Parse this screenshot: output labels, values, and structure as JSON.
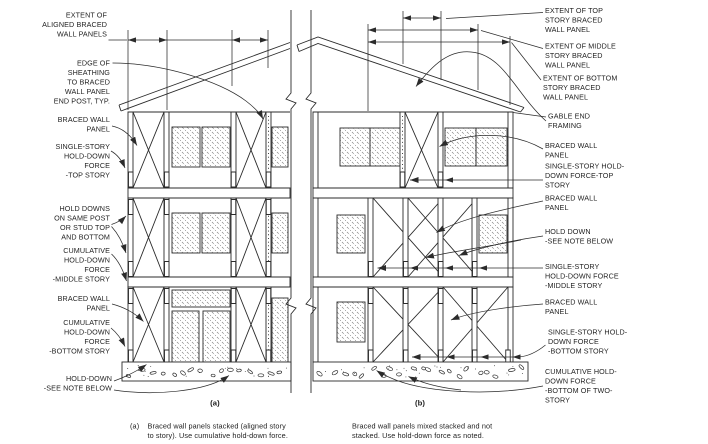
{
  "diagram": {
    "left_labels": [
      {
        "lines": [
          "EXTENT OF",
          "ALIGNED BRACED",
          "WALL PANELS"
        ]
      },
      {
        "lines": [
          "EDGE OF",
          "SHEATHING",
          "TO BRACED",
          "WALL PANEL",
          "END POST, TYP."
        ]
      },
      {
        "lines": [
          "BRACED WALL",
          "PANEL"
        ]
      },
      {
        "lines": [
          "SINGLE-STORY",
          "HOLD-DOWN",
          "FORCE",
          "-TOP STORY"
        ]
      },
      {
        "lines": [
          "HOLD DOWNS",
          "ON SAME POST",
          "OR STUD TOP",
          "AND BOTTOM"
        ]
      },
      {
        "lines": [
          "CUMULATIVE",
          "HOLD-DOWN",
          "FORCE",
          "-MIDDLE STORY"
        ]
      },
      {
        "lines": [
          "BRACED WALL",
          "PANEL"
        ]
      },
      {
        "lines": [
          "CUMULATIVE",
          "HOLD-DOWN",
          "FORCE",
          "-BOTTOM STORY"
        ]
      },
      {
        "lines": [
          "HOLD-DOWN",
          "-SEE NOTE BELOW"
        ]
      }
    ],
    "right_labels": [
      {
        "lines": [
          "EXTENT OF TOP",
          "STORY BRACED",
          "WALL PANEL"
        ]
      },
      {
        "lines": [
          "EXTENT OF MIDDLE",
          "STORY BRACED",
          "WALL PANEL"
        ]
      },
      {
        "lines": [
          "EXTENT OF BOTTOM",
          "STORY BRACED",
          "WALL PANEL"
        ]
      },
      {
        "lines": [
          "GABLE END",
          "FRAMING"
        ]
      },
      {
        "lines": [
          "BRACED WALL",
          "PANEL"
        ]
      },
      {
        "lines": [
          "SINGLE-STORY HOLD-",
          "DOWN FORCE-TOP",
          "STORY"
        ]
      },
      {
        "lines": [
          "BRACED WALL",
          "PANEL"
        ]
      },
      {
        "lines": [
          "HOLD DOWN",
          "-SEE NOTE BELOW"
        ]
      },
      {
        "lines": [
          "SINGLE-STORY",
          "HOLD-DOWN FORCE",
          "-MIDDLE STORY"
        ]
      },
      {
        "lines": [
          "BRACED WALL",
          "PANEL"
        ]
      },
      {
        "lines": [
          "SINGLE-STORY HOLD-",
          "DOWN FORCE",
          "-BOTTOM STORY"
        ]
      },
      {
        "lines": [
          "CUMULATIVE HOLD-",
          "DOWN FORCE",
          "-BOTTOM OF TWO-",
          "STORY"
        ]
      }
    ],
    "subfigures": {
      "a": "(a)",
      "b": "(b)"
    },
    "captions": {
      "a_prefix": "(a)",
      "a": [
        "Braced wall panels stacked (aligned story",
        "to story). Use cumulative hold-down force."
      ],
      "b": [
        "Braced wall panels mixed stacked and not",
        "stacked. Use hold-down force as noted."
      ]
    },
    "colors": {
      "line": "#2b2b2b",
      "text": "#1f1f1f",
      "background": "#ffffff",
      "hatch": "#6a6a6a"
    }
  }
}
